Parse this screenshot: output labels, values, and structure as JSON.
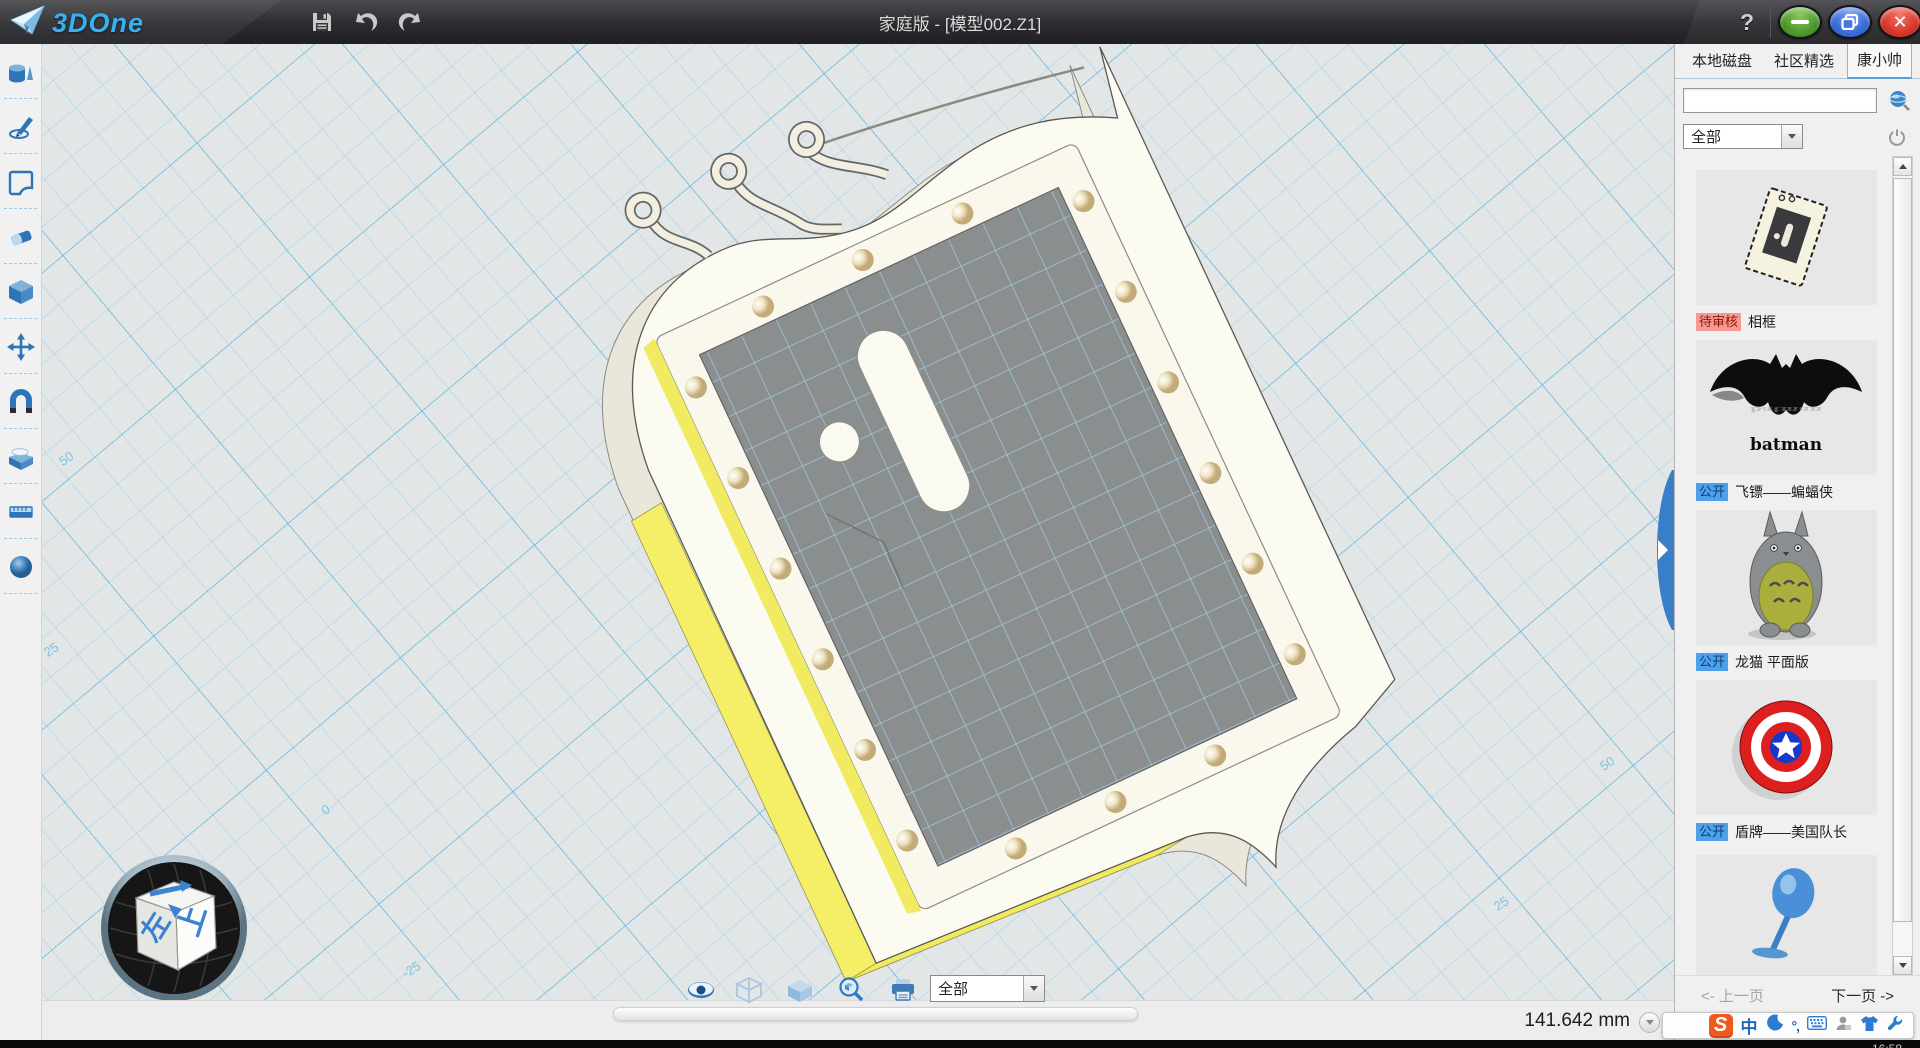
{
  "titlebar": {
    "logo_text": "3DOne",
    "title": "家庭版 - [模型002.Z1]",
    "help": "?",
    "close_glyph": "✕"
  },
  "left_toolbar": {
    "icons": [
      "primitive-solids",
      "sketch-draw",
      "sketch-plane",
      "eraser",
      "feature-cube",
      "move-transform",
      "magnet-assembly",
      "material-box",
      "measure-ruler",
      "render-sphere"
    ]
  },
  "canvas": {
    "axis_labels": [
      {
        "text": "50"
      },
      {
        "text": "25"
      },
      {
        "text": "0"
      },
      {
        "text": "-25"
      },
      {
        "text": "25"
      },
      {
        "text": "50"
      }
    ],
    "view_cube": {
      "top": "前",
      "right": "上",
      "left": "左"
    },
    "measurement": "141.642 mm"
  },
  "bottom_toolbar": {
    "icons": [
      "visibility-eye",
      "wireframe-display",
      "shaded-display",
      "zoom-view",
      "print"
    ],
    "filter_value": "全部"
  },
  "sidebar": {
    "tabs": [
      {
        "label": "本地磁盘",
        "active": false
      },
      {
        "label": "社区精选",
        "active": false
      },
      {
        "label": "康小帅",
        "active": true
      }
    ],
    "search": {
      "value": "",
      "placeholder": ""
    },
    "category_filter": "全部",
    "items": [
      {
        "badge": "待审核",
        "badge_style": "pending",
        "title": "相框",
        "thumb": "photo-frame"
      },
      {
        "badge": "公开",
        "badge_style": "public",
        "title": "飞镖——蝙蝠侠",
        "caption": "batman",
        "thumb": "batman-logo"
      },
      {
        "badge": "公开",
        "badge_style": "public",
        "title": "龙猫 平面版",
        "thumb": "totoro"
      },
      {
        "badge": "公开",
        "badge_style": "public",
        "title": "盾牌——美国队长",
        "thumb": "captain-shield"
      },
      {
        "badge": "",
        "badge_style": "",
        "title": "",
        "thumb": "blue-pin"
      }
    ],
    "pagination": {
      "prev": "<- 上一页",
      "next": "下一页 ->"
    }
  },
  "taskbar": {
    "ime": {
      "logo": "S",
      "lang": "中",
      "punct": "°,"
    },
    "clock": "16:58"
  },
  "colors": {
    "accent_blue": "#2e7cc3",
    "frame_yellow": "#f4ef67",
    "grid_blue": "#6fbfe4",
    "badge_pending_bg": "#f59a92",
    "badge_public_bg": "#4da1ec",
    "close_red": "#d8372a",
    "minimize_green": "#4d9a2c",
    "maximize_blue": "#3a6cd8"
  }
}
